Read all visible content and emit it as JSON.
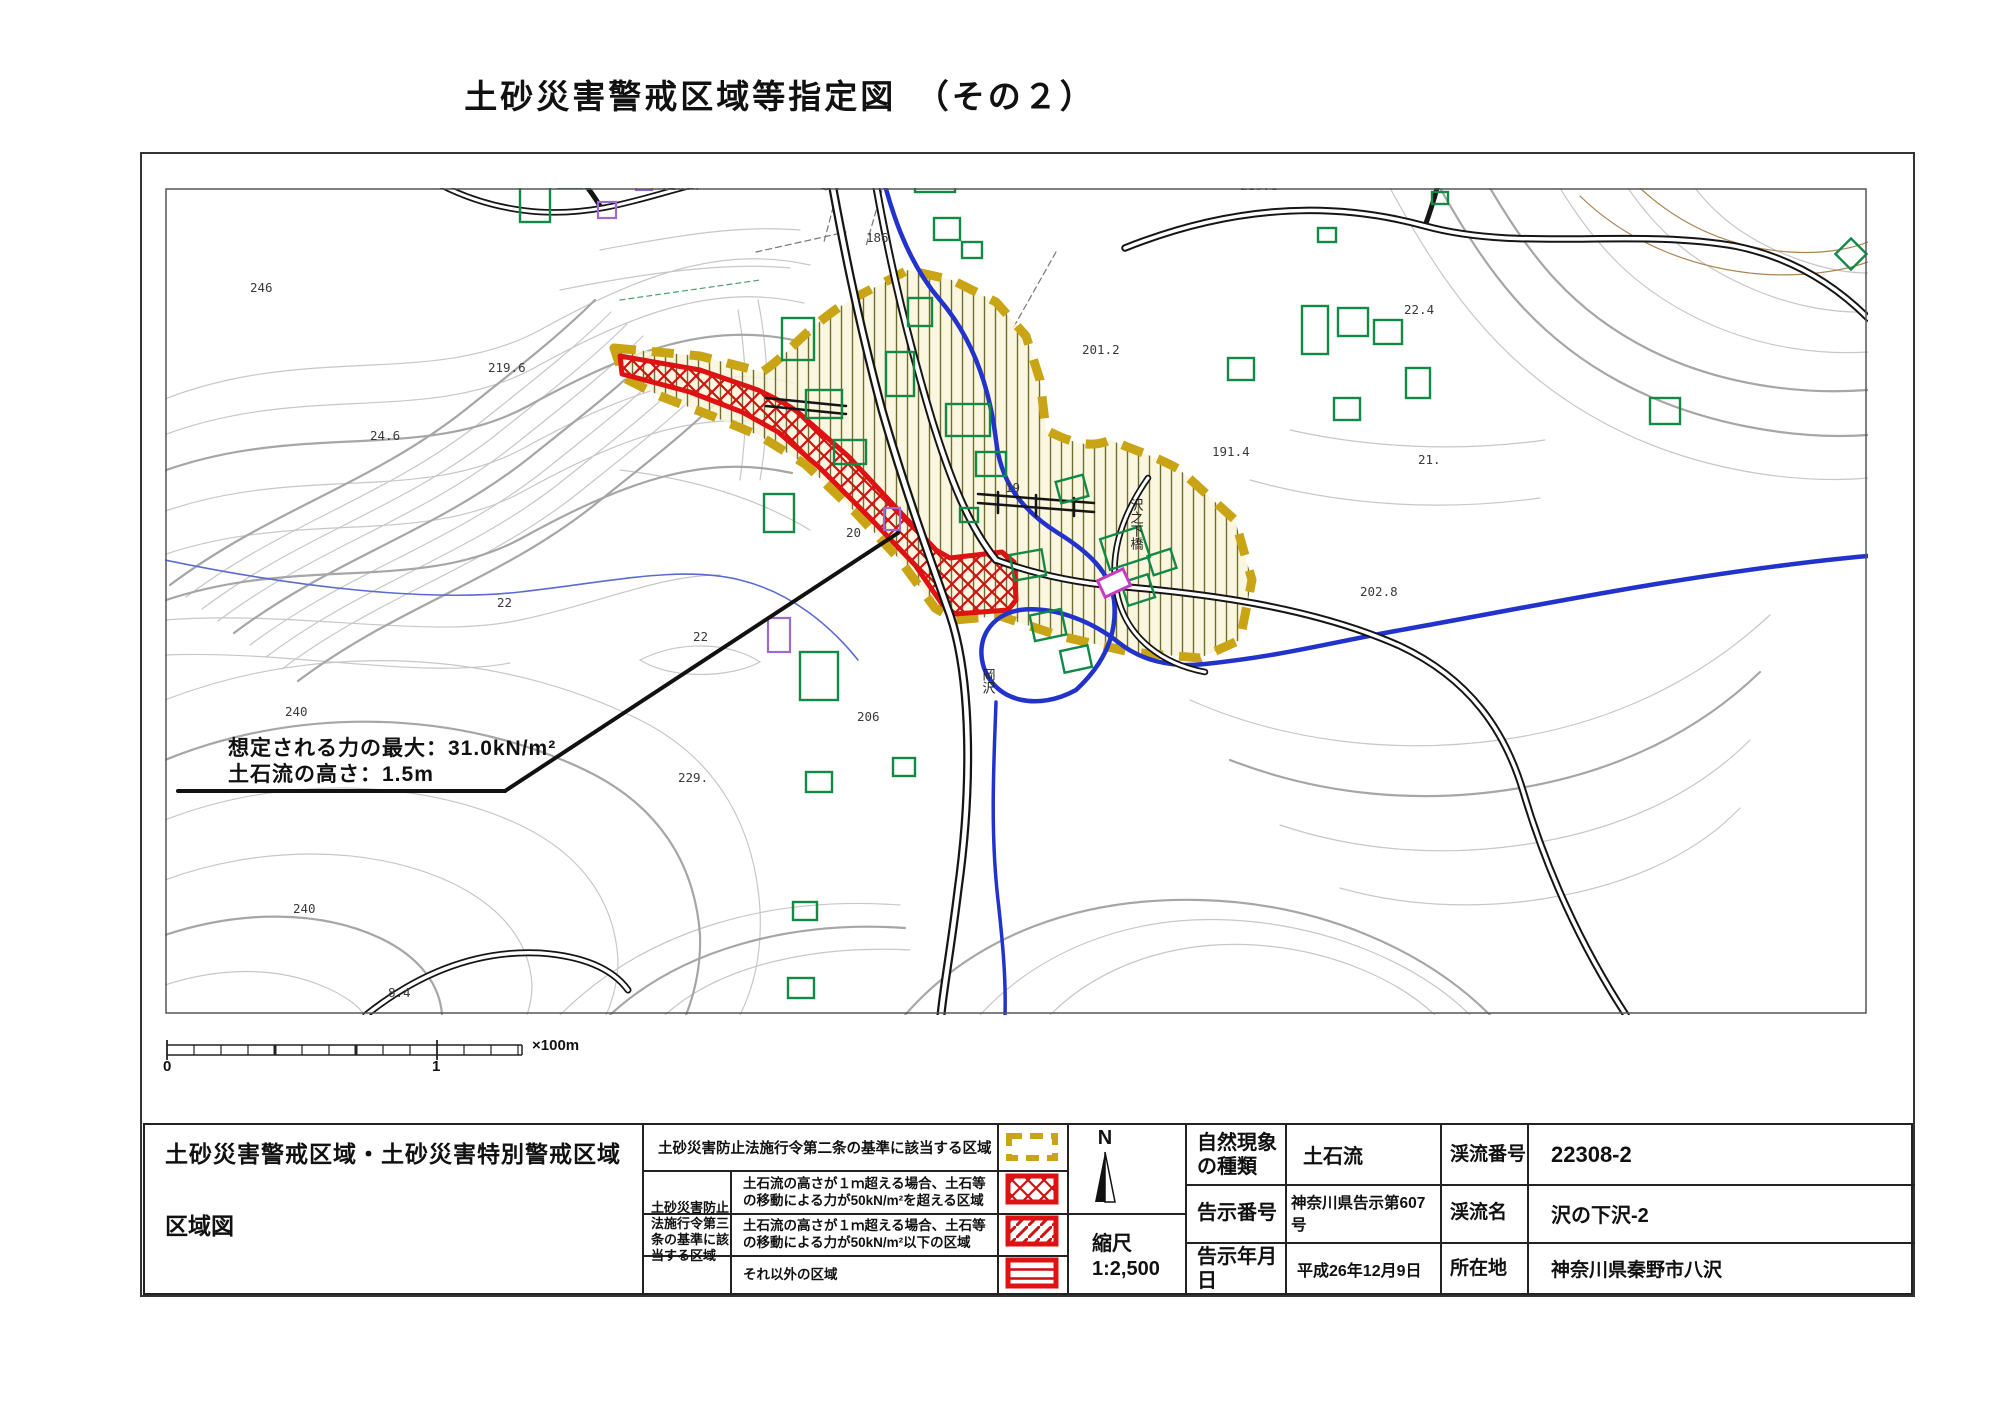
{
  "title": "土砂災害警戒区域等指定図　（その２）",
  "map": {
    "annotation_line1": "想定される力の最大：31.0kN/m²",
    "annotation_line2": "土石流の高さ：1.5m",
    "labels": [
      {
        "t": "210.4",
        "x": 662,
        "y": 190
      },
      {
        "t": "186",
        "x": 866,
        "y": 242
      },
      {
        "t": "219.1",
        "x": 1240,
        "y": 190
      },
      {
        "t": "246",
        "x": 250,
        "y": 292
      },
      {
        "t": "22.4",
        "x": 1404,
        "y": 314
      },
      {
        "t": "201.2",
        "x": 1082,
        "y": 354
      },
      {
        "t": "219.6",
        "x": 488,
        "y": 372
      },
      {
        "t": "24.6",
        "x": 370,
        "y": 440
      },
      {
        "t": "191.4",
        "x": 1212,
        "y": 456
      },
      {
        "t": "21.",
        "x": 1418,
        "y": 464
      },
      {
        "t": "20",
        "x": 846,
        "y": 537
      },
      {
        "t": "19",
        "x": 1005,
        "y": 492
      },
      {
        "t": "202.8",
        "x": 1360,
        "y": 596
      },
      {
        "t": "22",
        "x": 497,
        "y": 607
      },
      {
        "t": "22",
        "x": 693,
        "y": 641
      },
      {
        "t": "206",
        "x": 857,
        "y": 721
      },
      {
        "t": "229.",
        "x": 678,
        "y": 782
      },
      {
        "t": "240",
        "x": 285,
        "y": 716
      },
      {
        "t": "240",
        "x": 293,
        "y": 913
      },
      {
        "t": "8.4",
        "x": 388,
        "y": 997
      }
    ],
    "vertical_labels": [
      {
        "t": "沢之下橋",
        "x": 1136,
        "y": 498
      },
      {
        "t": "岡沢",
        "x": 988,
        "y": 668
      }
    ]
  },
  "scale_bar": {
    "zero": "0",
    "one": "1",
    "unit": "×100m"
  },
  "legend": {
    "doc_title_line1": "土砂災害警戒区域・土砂災害特別警戒区域",
    "doc_title_line2": "区域図",
    "article2_label": "土砂災害防止法施行令第二条の基準に該当する区域",
    "article3_label": "土砂災害防止法施行令第三条の基準に該当する区域",
    "rows": [
      {
        "label": "土石流の高さが１ｍ超える場合、土石等の移動による力が50kN/m²を超える区域",
        "swatch": "red-crosshatch"
      },
      {
        "label": "土石流の高さが１ｍ超える場合、土石等の移動による力が50kN/m²以下の区域",
        "swatch": "red-diagonal"
      },
      {
        "label": "それ以外の区域",
        "swatch": "red-horizontal"
      }
    ],
    "colors": {
      "warning_yellow": "#C9A415",
      "special_red": "#DE1212"
    }
  },
  "compass_label": "N",
  "scale_box": {
    "label": "縮尺",
    "value": "1:2,500"
  },
  "info": {
    "rows": [
      [
        "自然現象の種類",
        "土石流",
        "渓流番号",
        "22308-2"
      ],
      [
        "告示番号",
        "神奈川県告示第607号",
        "渓流名",
        "沢の下沢-2"
      ],
      [
        "告示年月日",
        "平成26年12月9日",
        "所在地",
        "神奈川県秦野市八沢"
      ]
    ]
  }
}
